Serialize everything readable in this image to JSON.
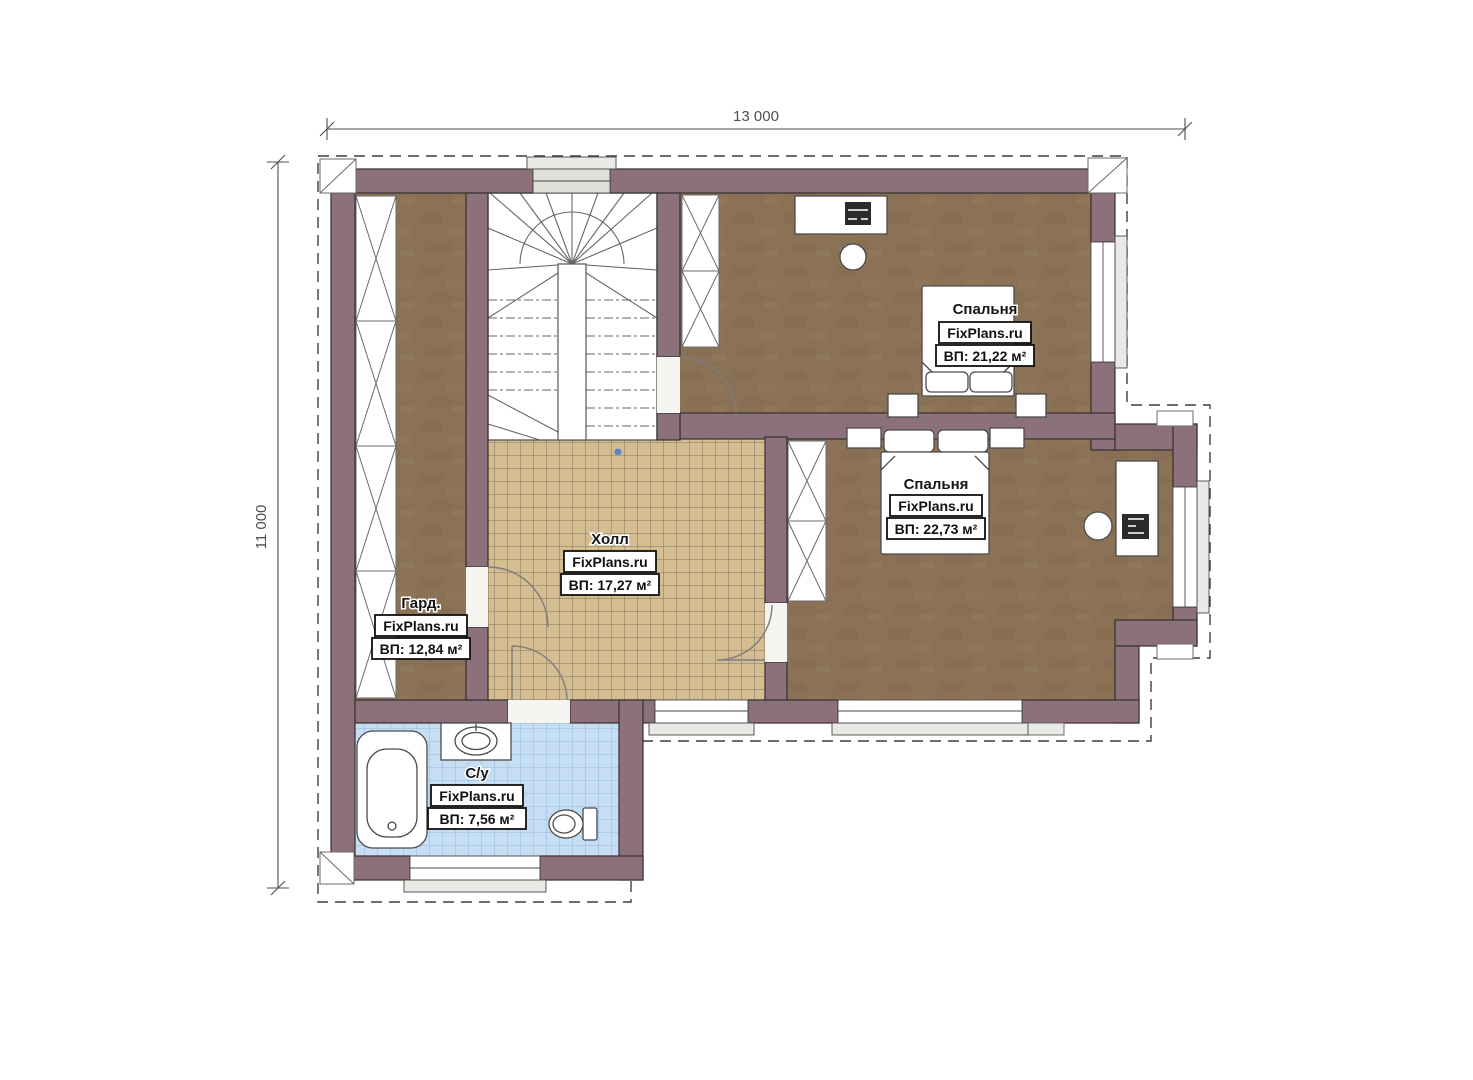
{
  "plan": {
    "dimensions": {
      "width_label": "13 000",
      "height_label": "11 000"
    },
    "rooms": [
      {
        "key": "bedroom-1",
        "name": "Спальня",
        "watermark": "FixPlans.ru",
        "area_label": "ВП: 21,22 м²"
      },
      {
        "key": "bedroom-2",
        "name": "Спальня",
        "watermark": "FixPlans.ru",
        "area_label": "ВП: 22,73 м²"
      },
      {
        "key": "hall",
        "name": "Холл",
        "watermark": "FixPlans.ru",
        "area_label": "ВП: 17,27 м²"
      },
      {
        "key": "wardrobe",
        "name": "Гард.",
        "watermark": "FixPlans.ru",
        "area_label": "ВП: 12,84 м²"
      },
      {
        "key": "bathroom",
        "name": "С/у",
        "watermark": "FixPlans.ru",
        "area_label": "ВП: 7,56 м²"
      }
    ],
    "colors": {
      "wall": "#8c717d",
      "wood_floor": "#8b7256",
      "hall_tile": "#d4bd90",
      "bath_tile": "#c6def4",
      "window_fill": "#dfe0da",
      "sill_fill": "#e9eae5",
      "outline": "#34302d"
    }
  }
}
